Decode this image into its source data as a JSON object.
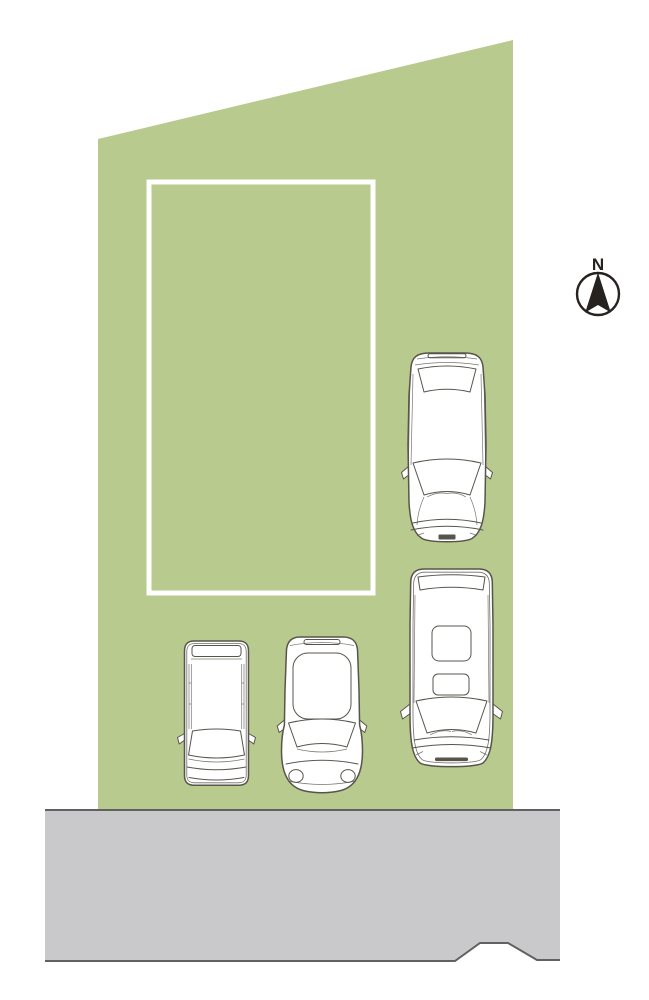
{
  "compass": {
    "label": "N"
  },
  "colors": {
    "background": "#ffffff",
    "plot_fill": "#b8ca8e",
    "building_stroke": "#ffffff",
    "road_fill": "#c9c9cb",
    "road_stroke": "#616161",
    "car_line": "#57544c",
    "car_fill": "#ffffff",
    "compass_ink": "#262220"
  },
  "plot": {
    "points": "98,139 513,40 513,812 98,812"
  },
  "building_outline": {
    "points": "149,182 373,182 373,593 149,593",
    "stroke_width": 5
  },
  "road": {
    "fill_points": "45,810 560,810 560,960 537,960 508,943 480,943 455,961 45,961",
    "top_edge": "45,810 560,810",
    "bottom_edge": "45,961 455,961 480,943 508,943 537,960 560,960"
  },
  "vehicles": [
    {
      "id": "station-wagon",
      "kind": "station-wagon-top-view",
      "transform": "translate(402,350)"
    },
    {
      "id": "minivan",
      "kind": "minivan-top-view",
      "transform": "translate(399,565)"
    },
    {
      "id": "compact-car",
      "kind": "compact-car-top-view",
      "transform": "translate(281,630)"
    },
    {
      "id": "kei-car",
      "kind": "kei-box-car-top-view",
      "transform": "translate(181,638)"
    }
  ]
}
